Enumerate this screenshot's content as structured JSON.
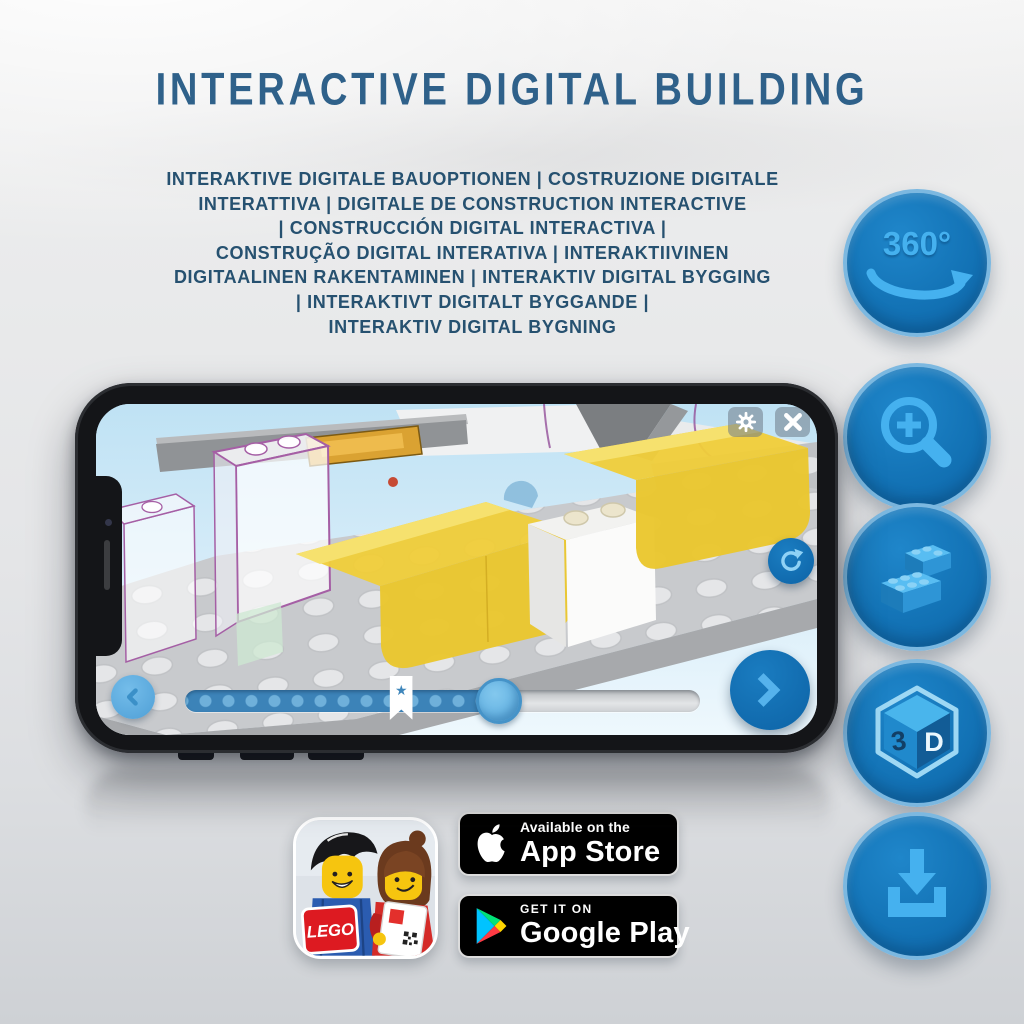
{
  "poster": {
    "title": "INTERACTIVE DIGITAL BUILDING",
    "title_color": "#2f618a",
    "subtitle_color": "#265170",
    "subtitle_lines": [
      "INTERAKTIVE DIGITALE BAUOPTIONEN | COSTRUZIONE DIGITALE",
      "INTERATTIVA | DIGITALE DE CONSTRUCTION INTERACTIVE",
      "| CONSTRUCCIÓN DIGITAL INTERACTIVA |",
      "CONSTRUÇÃO DIGITAL INTERATIVA | INTERAKTIIVINEN",
      "DIGITAALINEN RAKENTAMINEN | INTERAKTIV DIGITAL BYGGING",
      "| INTERAKTIVT DIGITALT BYGGANDE |",
      "INTERAKTIV DIGITAL BYGNING"
    ]
  },
  "features": {
    "accent_color": "#1173ba",
    "glyph_color": "#45b1ef",
    "ring_color": "#7cb8e0",
    "items": [
      "360-degree-rotation",
      "zoom-in",
      "lego-brick",
      "3d-view",
      "download"
    ],
    "rotate_label": "360°",
    "cube_letter_3": "3",
    "cube_letter_d": "D"
  },
  "phone": {
    "slider": {
      "progress_percent": 61,
      "bookmark_percent": 42,
      "star_glyph": "★"
    }
  },
  "badges": {
    "lego_logo_text": "LEGO",
    "app_store": {
      "line1": "Available on the",
      "line2": "App Store"
    },
    "google_play": {
      "line1": "GET IT ON",
      "line2": "Google Play"
    }
  }
}
